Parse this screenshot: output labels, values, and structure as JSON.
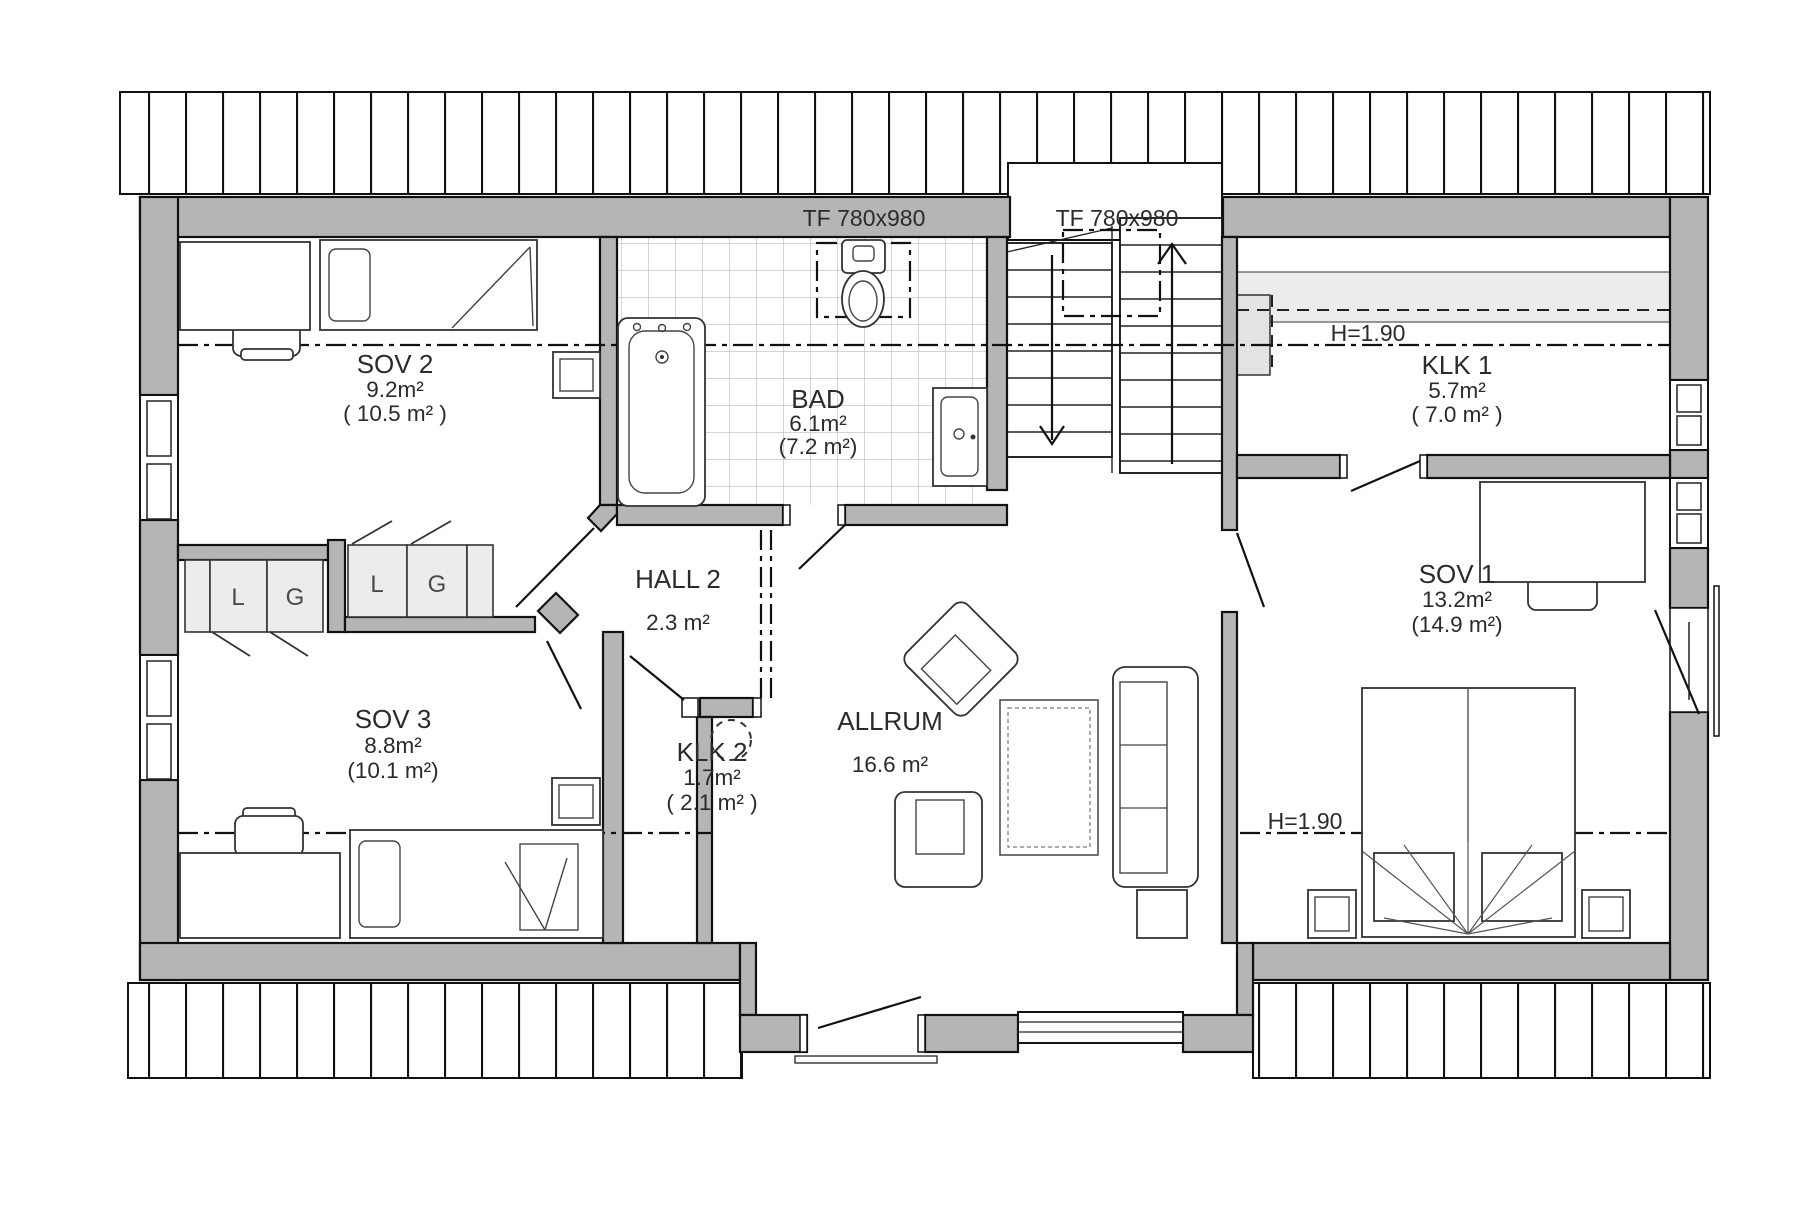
{
  "rooms": {
    "sov2": {
      "name": "SOV 2",
      "area": "9.2m²",
      "gross": "( 10.5 m² )"
    },
    "bad": {
      "name": "BAD",
      "area": "6.1m²",
      "gross": "(7.2 m²)"
    },
    "hall2": {
      "name": "HALL 2",
      "area": "2.3 m²"
    },
    "sov3": {
      "name": "SOV 3",
      "area": "8.8m²",
      "gross": "(10.1 m²)"
    },
    "klk2": {
      "name": "KLK 2",
      "area": "1.7m²",
      "gross": "( 2.1 m² )"
    },
    "allrum": {
      "name": "ALLRUM",
      "area": "16.6 m²"
    },
    "klk1": {
      "name": "KLK 1",
      "area": "5.7m²",
      "gross": "( 7.0 m² )"
    },
    "sov1": {
      "name": "SOV 1",
      "area": "13.2m²",
      "gross": "(14.9 m²)"
    }
  },
  "annotations": {
    "roof_window_bath": "TF 780x980",
    "roof_window_stair": "TF 780x980",
    "height_line_upper": "H=1.90",
    "height_line_lower": "H=1.90"
  },
  "closets": {
    "sov3_left": "L",
    "sov3_right": "G",
    "sov2_left": "L",
    "sov2_right": "G"
  },
  "colors": {
    "wall": "#b5b5b5",
    "closet_fill": "#ececec",
    "storage_band": "#ececec",
    "line": "#1a1a1a",
    "tile_line": "#b9b9b9"
  }
}
